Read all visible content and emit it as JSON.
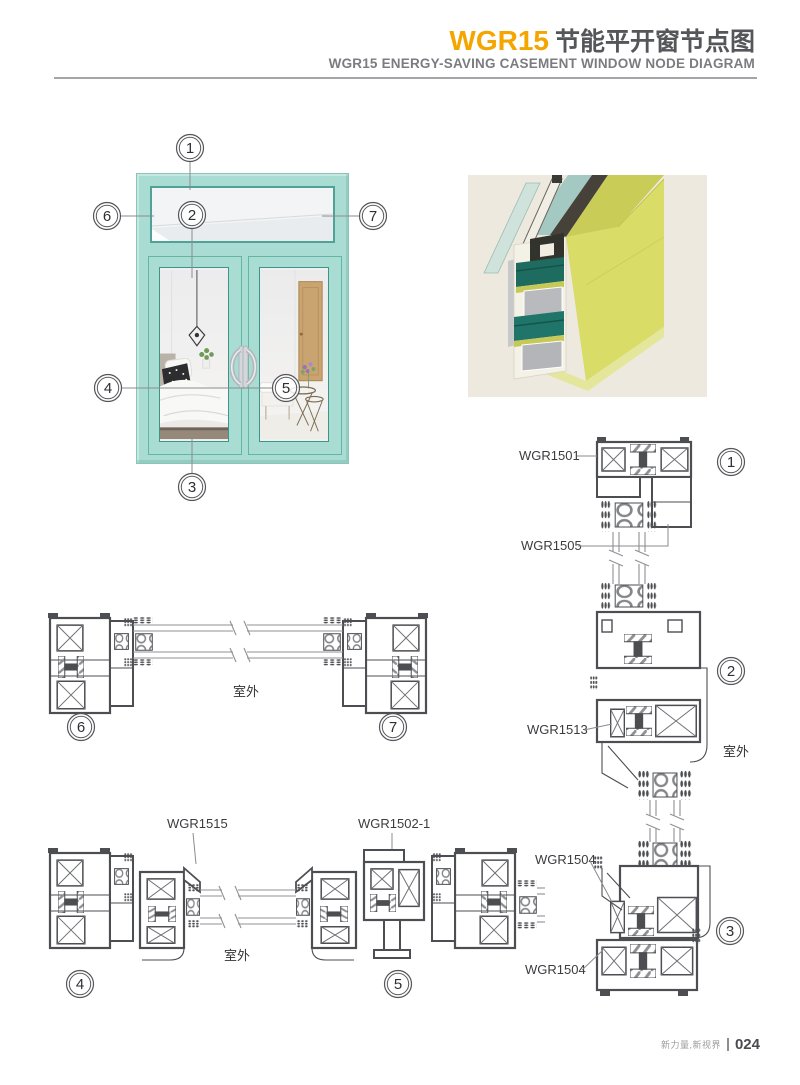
{
  "header": {
    "product_code": "WGR15",
    "title_cn": "节能平开窗节点图",
    "subtitle_en": "WGR15 ENERGY-SAVING CASEMENT WINDOW NODE DIAGRAM"
  },
  "illustration": {
    "callouts": [
      "1",
      "2",
      "3",
      "4",
      "5",
      "6",
      "7"
    ]
  },
  "sections": {
    "mid": {
      "callout_left": "6",
      "callout_right": "7",
      "outdoor": "室外"
    },
    "bottom": {
      "label_left": "WGR1515",
      "label_right": "WGR1502-1",
      "callout_left": "4",
      "callout_right": "5",
      "outdoor": "室外"
    },
    "right": {
      "labels": {
        "l1": "WGR1501",
        "l2": "WGR1505",
        "l3": "WGR1513",
        "l4": "WGR1504",
        "l5": "WGR1504"
      },
      "callouts": {
        "c1": "1",
        "c2": "2",
        "c3": "3"
      },
      "outdoor": "室外"
    }
  },
  "footer": {
    "tagline": "新力量,新视界",
    "page_number": "024"
  },
  "colors": {
    "accent_orange": "#F5A500",
    "title_gray": "#55565A",
    "frame_teal": "#A9DCD2",
    "render_yellow": "#D9DC66",
    "render_teal": "#1E6B60",
    "drawing_line": "#4D4E52"
  }
}
